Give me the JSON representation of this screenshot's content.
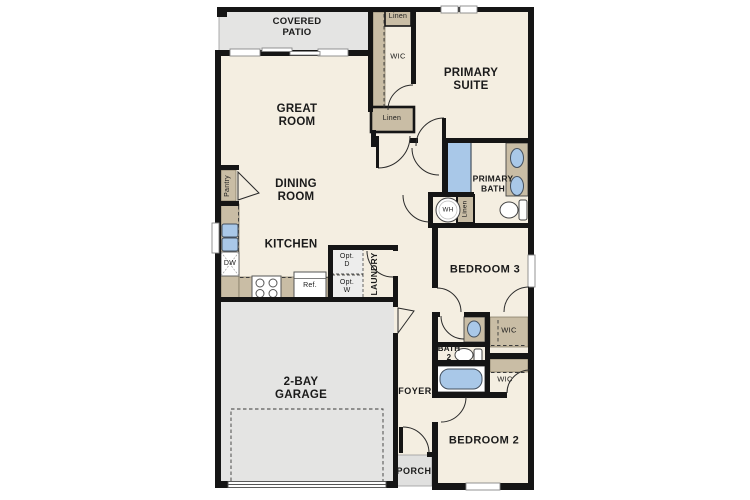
{
  "plan_type": "single-story residential floor plan",
  "rooms": {
    "covered_patio": "COVERED\nPATIO",
    "great_room": "GREAT\nROOM",
    "dining_room": "DINING\nROOM",
    "kitchen": "KITCHEN",
    "primary_suite": "PRIMARY\nSUITE",
    "primary_bath": "PRIMARY\nBATH",
    "bedroom_3": "BEDROOM 3",
    "bedroom_2": "BEDROOM 2",
    "bath_2": "BATH\n2",
    "laundry": "LAUNDRY",
    "foyer": "FOYER",
    "porch": "PORCH",
    "garage": "2-BAY\nGARAGE"
  },
  "closets": {
    "wic_primary": "WIC",
    "wic_bedroom3": "WIC",
    "wic_bedroom2": "WIC",
    "linen_top": "Linen",
    "linen_hall": "Linen",
    "linen_wh": "Linen",
    "pantry": "Pantry"
  },
  "fixtures": {
    "water_heater": "WH",
    "dishwasher": "DW",
    "refrigerator": "Ref.",
    "optional_dryer": "Opt.\nD",
    "optional_washer": "Opt.\nW"
  },
  "colors": {
    "wall": "#151515",
    "floor": "#f4eee1",
    "cabinet_tan": "#c9bda5",
    "concrete_gray": "#e4e4e3",
    "fixture_blue": "#a9c8e8"
  }
}
